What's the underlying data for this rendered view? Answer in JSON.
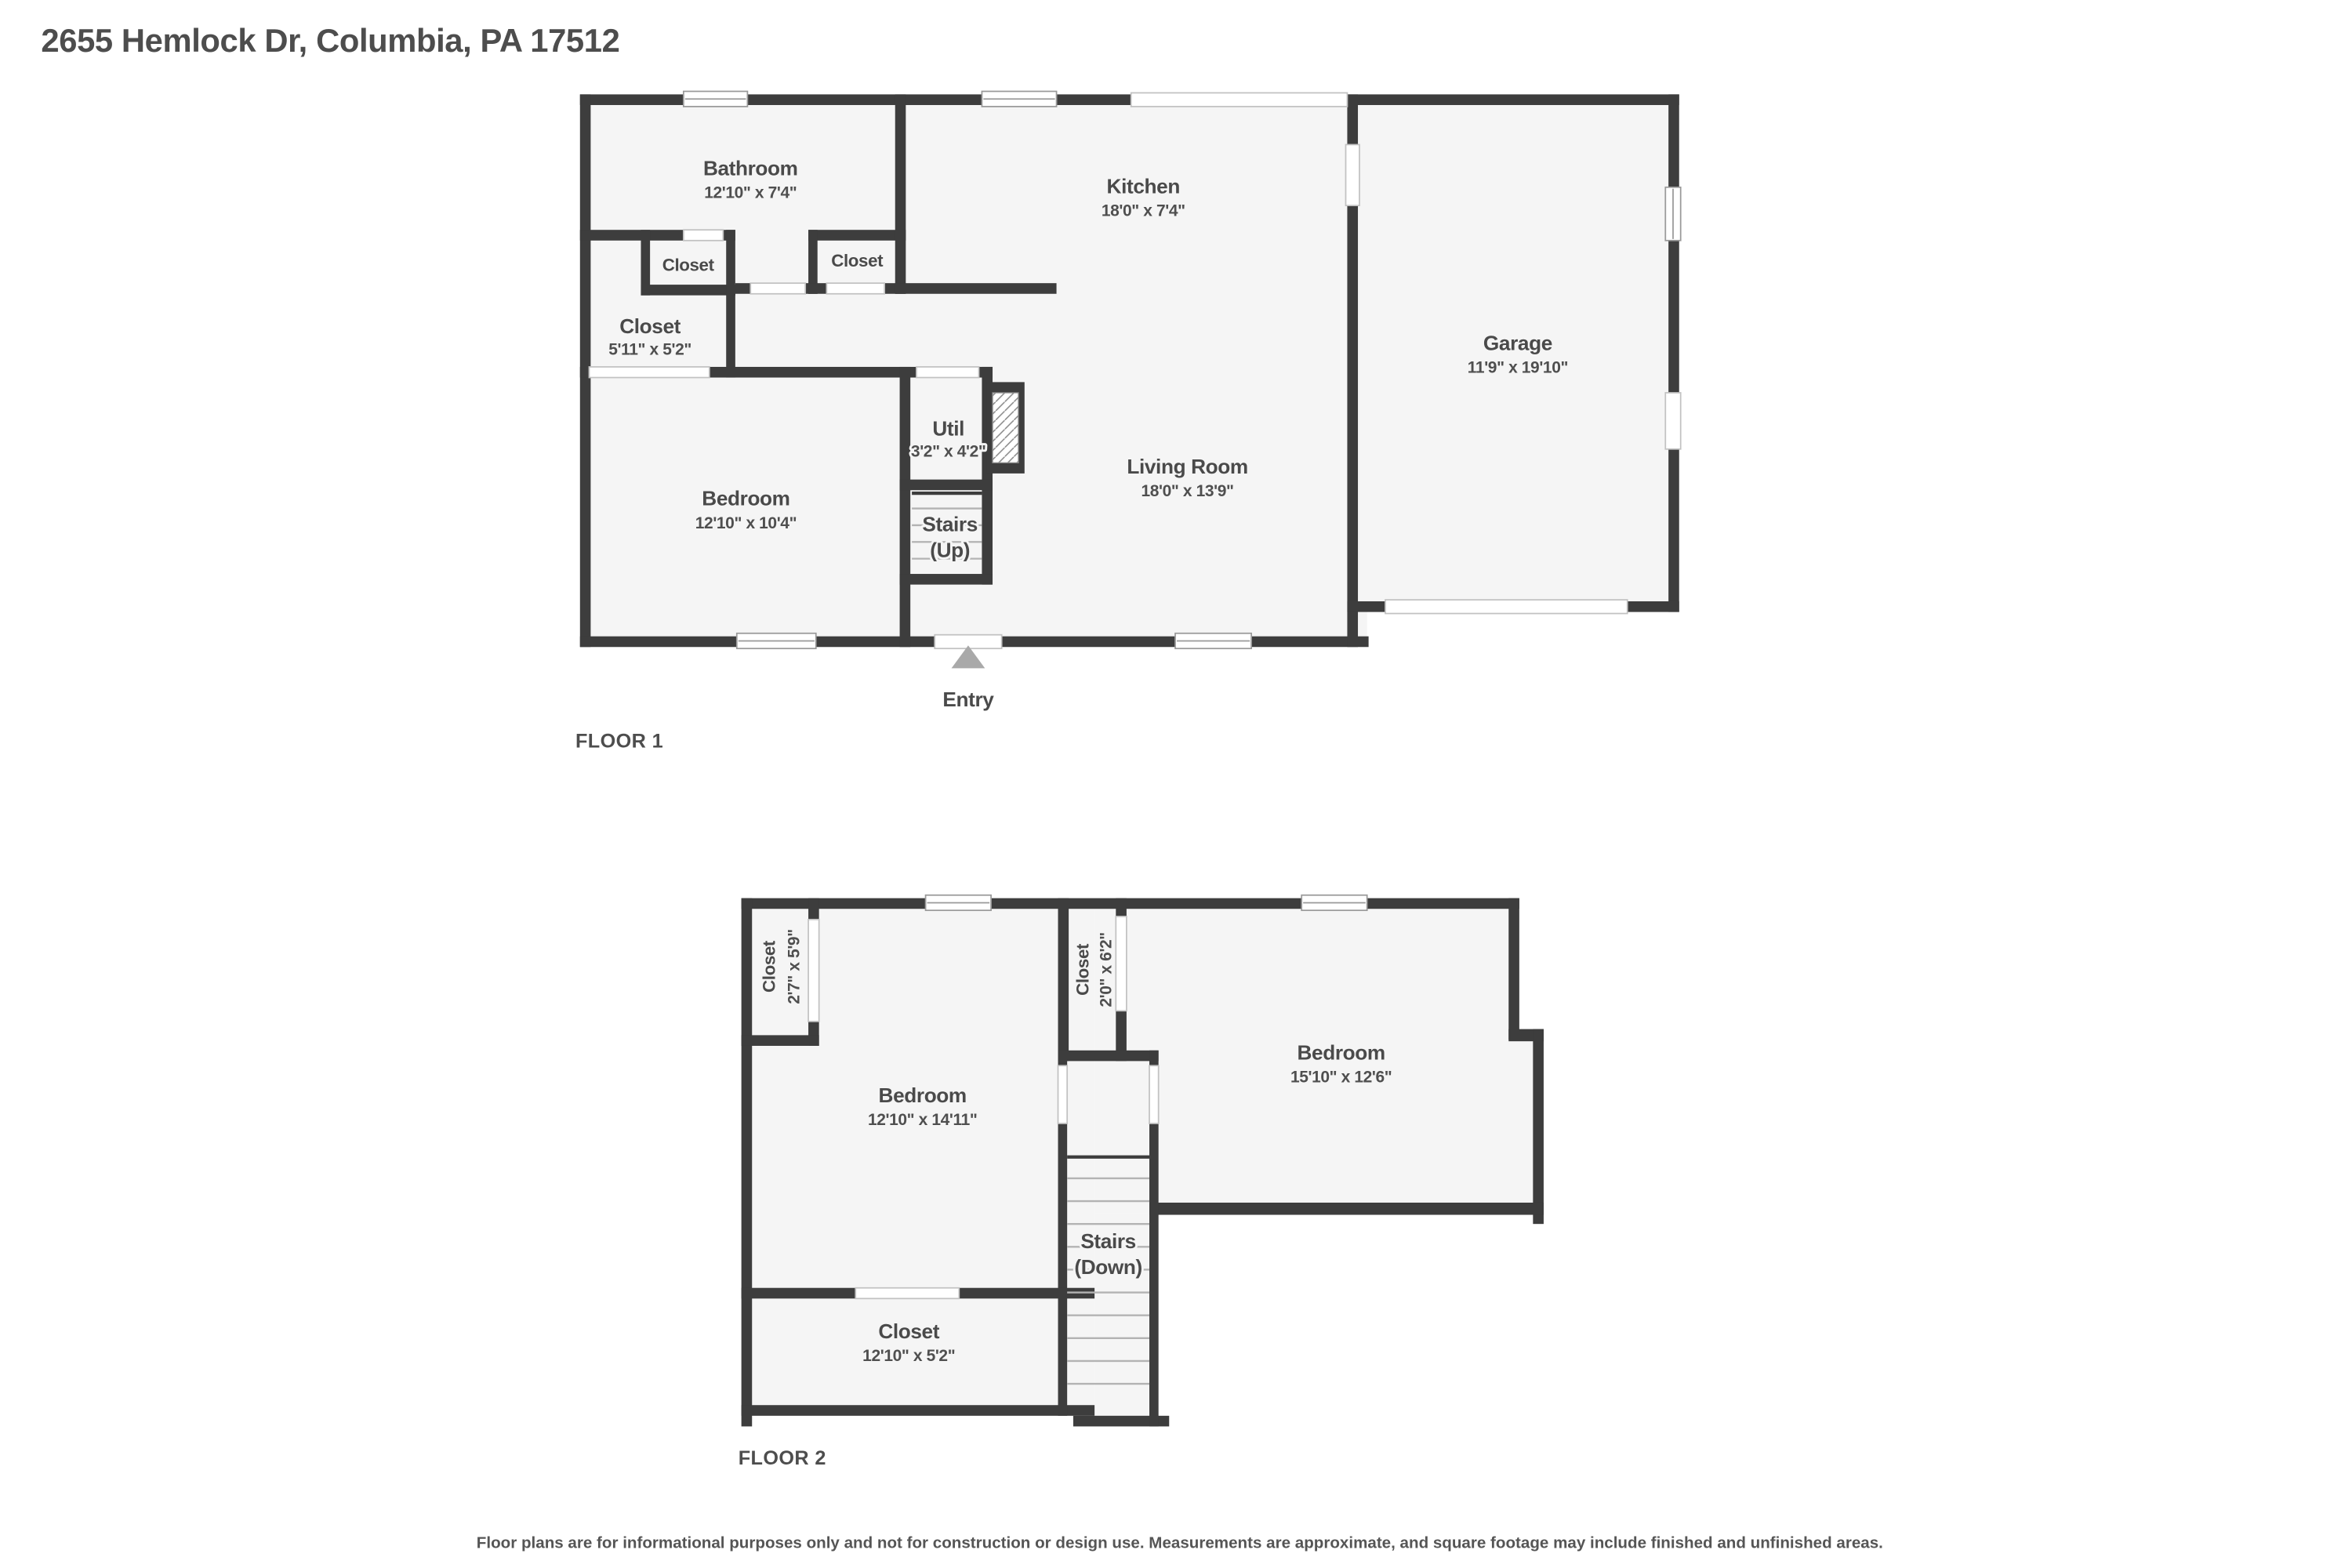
{
  "title": "2655 Hemlock Dr, Columbia, PA 17512",
  "disclaimer": "Floor plans are for informational purposes only and not for construction or design use. Measurements are approximate, and square footage may include finished and unfinished areas.",
  "colors": {
    "wall": "#3d3d3d",
    "floor_fill": "#f5f5f5",
    "text": "#4a4a4a",
    "entry_arrow": "#a9a9a9",
    "window_outline": "#9a9a9a"
  },
  "floor1": {
    "label": "FLOOR 1",
    "bathroom": {
      "name": "Bathroom",
      "dims": "12'10\" x 7'4\""
    },
    "kitchen": {
      "name": "Kitchen",
      "dims": "18'0\" x 7'4\""
    },
    "garage": {
      "name": "Garage",
      "dims": "11'9\" x 19'10\""
    },
    "closet_small_left": {
      "name": "Closet"
    },
    "closet_small_right": {
      "name": "Closet"
    },
    "closet_hall": {
      "name": "Closet",
      "dims": "5'11\" x 5'2\""
    },
    "bedroom": {
      "name": "Bedroom",
      "dims": "12'10\" x 10'4\""
    },
    "util": {
      "name": "Util",
      "dims": "3'2\" x 4'2\""
    },
    "stairs": {
      "name": "Stairs",
      "dir": "(Up)"
    },
    "living_room": {
      "name": "Living Room",
      "dims": "18'0\" x 13'9\""
    },
    "entry": {
      "name": "Entry"
    }
  },
  "floor2": {
    "label": "FLOOR 2",
    "closet_left": {
      "name": "Closet",
      "dims": "2'7\" x 5'9\""
    },
    "closet_mid": {
      "name": "Closet",
      "dims": "2'0\" x 6'2\""
    },
    "bedroom_left": {
      "name": "Bedroom",
      "dims": "12'10\" x 14'11\""
    },
    "bedroom_right": {
      "name": "Bedroom",
      "dims": "15'10\" x 12'6\""
    },
    "stairs": {
      "name": "Stairs",
      "dir": "(Down)"
    },
    "closet_bottom": {
      "name": "Closet",
      "dims": "12'10\" x 5'2\""
    }
  }
}
